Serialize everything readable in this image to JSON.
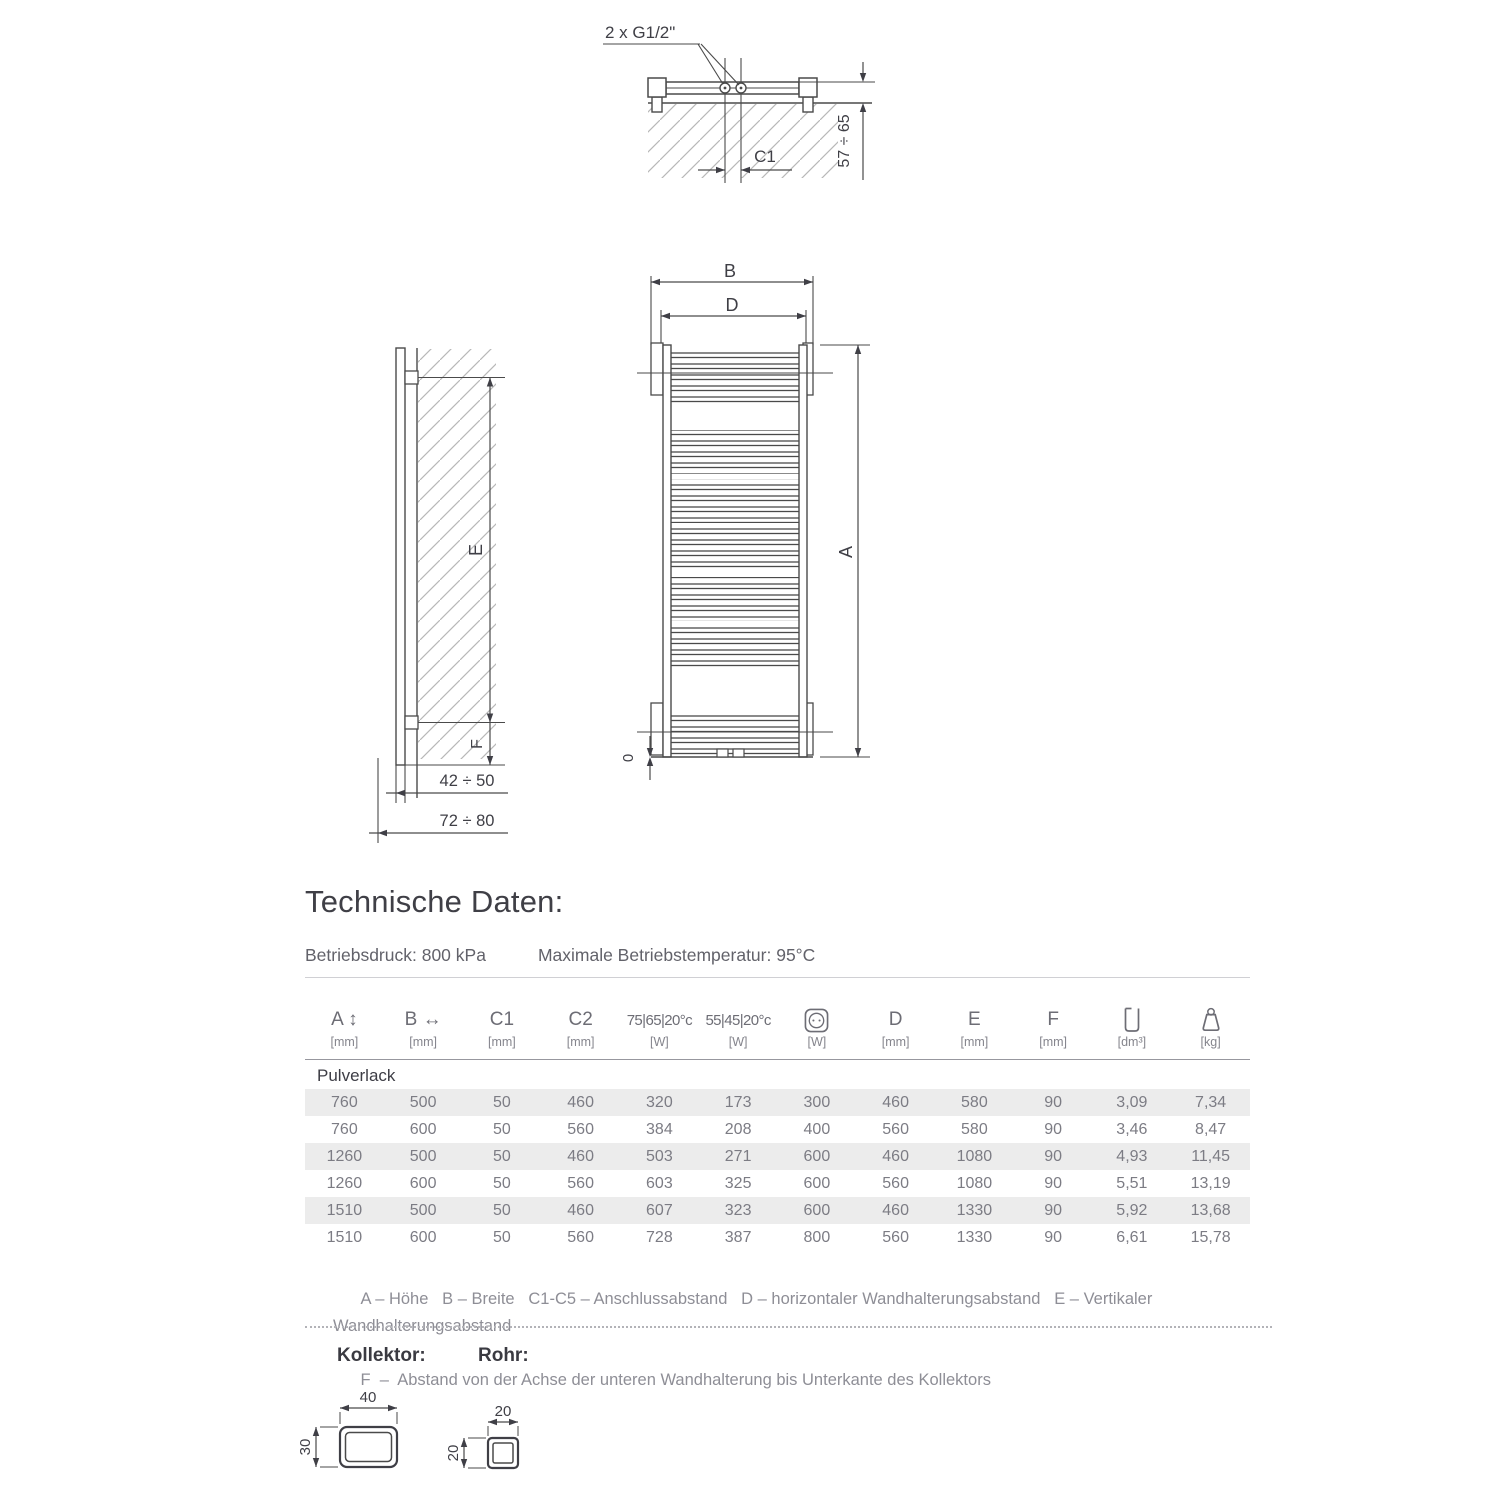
{
  "title": "Technische Daten:",
  "specs": {
    "pressure": "Betriebsdruck: 800 kPa",
    "temperature": "Maximale Betriebstemperatur: 95°C"
  },
  "drawing": {
    "top_view": {
      "connection_label": "2 x G1/2\"",
      "c1_label": "C1",
      "wall_distance": "57 ÷ 65"
    },
    "side_view": {
      "e_label": "E",
      "f_label": "F",
      "depth1": "42 ÷ 50",
      "depth2": "72 ÷ 80"
    },
    "front_view": {
      "b_label": "B",
      "d_label": "D",
      "a_label": "A",
      "zero_label": "0"
    }
  },
  "icons": {
    "power": "power-socket-icon",
    "water_content": "water-content-icon",
    "weight": "weight-icon"
  },
  "table": {
    "header": [
      {
        "label": "A ↕",
        "unit": "[mm]"
      },
      {
        "label": "B ↔",
        "unit": "[mm]"
      },
      {
        "label": "C1",
        "unit": "[mm]"
      },
      {
        "label": "C2",
        "unit": "[mm]"
      },
      {
        "label": "75|65|20°c",
        "unit": "[W]"
      },
      {
        "label": "55|45|20°c",
        "unit": "[W]"
      },
      {
        "label": "",
        "unit": "[W]"
      },
      {
        "label": "D",
        "unit": "[mm]"
      },
      {
        "label": "E",
        "unit": "[mm]"
      },
      {
        "label": "F",
        "unit": "[mm]"
      },
      {
        "label": "",
        "unit": "[dm³]"
      },
      {
        "label": "",
        "unit": "[kg]"
      }
    ],
    "group_label": "Pulverlack",
    "rows": [
      {
        "cells": [
          "760",
          "500",
          "50",
          "460",
          "320",
          "173",
          "300",
          "460",
          "580",
          "90",
          "3,09",
          "7,34"
        ]
      },
      {
        "cells": [
          "760",
          "600",
          "50",
          "560",
          "384",
          "208",
          "400",
          "560",
          "580",
          "90",
          "3,46",
          "8,47"
        ]
      },
      {
        "cells": [
          "1260",
          "500",
          "50",
          "460",
          "503",
          "271",
          "600",
          "460",
          "1080",
          "90",
          "4,93",
          "11,45"
        ]
      },
      {
        "cells": [
          "1260",
          "600",
          "50",
          "560",
          "603",
          "325",
          "600",
          "560",
          "1080",
          "90",
          "5,51",
          "13,19"
        ]
      },
      {
        "cells": [
          "1510",
          "500",
          "50",
          "460",
          "607",
          "323",
          "600",
          "460",
          "1330",
          "90",
          "5,92",
          "13,68"
        ]
      },
      {
        "cells": [
          "1510",
          "600",
          "50",
          "560",
          "728",
          "387",
          "800",
          "560",
          "1330",
          "90",
          "6,61",
          "15,78"
        ]
      }
    ],
    "legend_line1": "A – Höhe   B – Breite   C1-C5 – Anschlussabstand   D – horizontaler Wandhalterungsabstand   E – Vertikaler Wandhalterungsabstand",
    "legend_line2": "F  –  Abstand von der Achse der unteren Wandhalterung bis Unterkante des Kollektors"
  },
  "profiles": {
    "kollektor_label": "Kollektor:",
    "rohr_label": "Rohr:",
    "kollektor_width": "40",
    "kollektor_height": "30",
    "rohr_width": "20",
    "rohr_height": "20"
  }
}
